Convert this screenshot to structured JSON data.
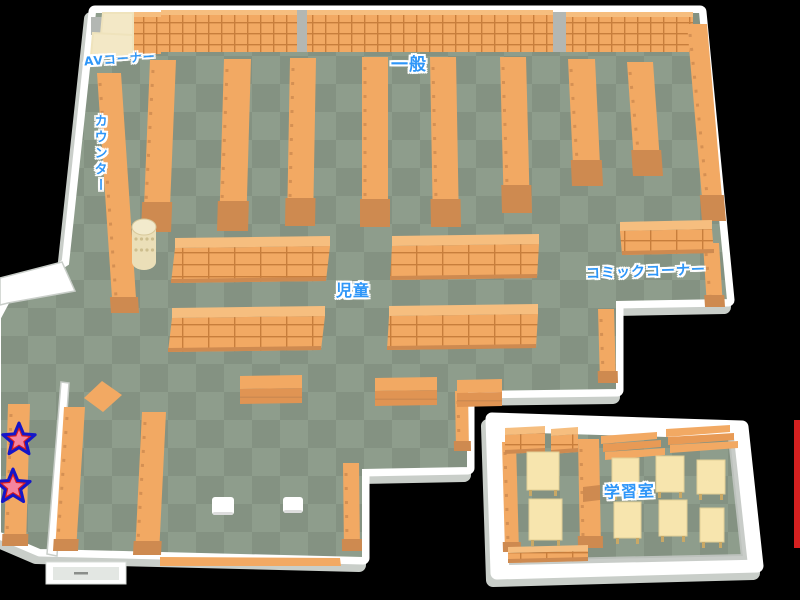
{
  "map": {
    "title_labels": "library floor map",
    "colors": {
      "bg": "#000000",
      "floorA": "#8E9D8C",
      "floorB": "#849282",
      "wall": "#FFFFFF",
      "wallShadow": "#C9CEC9",
      "wallInner": "#C2C6C2",
      "shelf": "#F2A963",
      "shelfLight": "#F6BE7F",
      "shelfDark": "#CE8A50",
      "shelfLine": "#C87E3C",
      "cream": "#F3E8C6",
      "cream2": "#EFE3BC",
      "desk": "#F7E5AE",
      "deskLeg": "#C9A865",
      "pillar": "#B3B7B3",
      "labelBlue": "#2E96F8",
      "starBlue": "#1616C8",
      "starRed": "#DC1C1C",
      "starPink": "#F5849E",
      "stool": "#FFFFFF",
      "red": "#D42020",
      "cylTop": "#F2EACC",
      "cylBody": "#EBDFB8",
      "cylDot": "#CDBE8E"
    },
    "rooms": [
      {
        "name": "main-hall-floor",
        "pts": [
          [
            95,
            12
          ],
          [
            700,
            12
          ],
          [
            728,
            300
          ],
          [
            617,
            302
          ],
          [
            617,
            390
          ],
          [
            468,
            392
          ],
          [
            468,
            468
          ],
          [
            363,
            470
          ],
          [
            363,
            558
          ],
          [
            40,
            550
          ],
          [
            0,
            533
          ],
          [
            0,
            318
          ],
          [
            8,
            303
          ],
          [
            68,
            264
          ]
        ]
      },
      {
        "name": "study-room-floor",
        "pts": [
          [
            504,
            431
          ],
          [
            731,
            438
          ],
          [
            744,
            557
          ],
          [
            509,
            562
          ]
        ],
        "outer": [
          [
            492,
            419
          ],
          [
            742,
            427
          ],
          [
            757,
            566
          ],
          [
            497,
            573
          ]
        ]
      }
    ],
    "wall_slivers": [
      {
        "name": "partition-wall",
        "pts": [
          [
            61,
            382
          ],
          [
            69,
            383
          ],
          [
            57,
            556
          ],
          [
            47,
            554
          ]
        ]
      },
      {
        "name": "west-jut-wall",
        "pts": [
          [
            0,
            278
          ],
          [
            62,
            262
          ],
          [
            75,
            291
          ],
          [
            8,
            303
          ],
          [
            0,
            305
          ]
        ]
      }
    ],
    "bands": [
      {
        "name": "wall-shelf-band",
        "x": 133,
        "y": 12,
        "w": 28,
        "h": 42
      },
      {
        "name": "wall-shelf-band",
        "x": 161,
        "y": 10,
        "w": 136,
        "h": 42
      },
      {
        "name": "wall-shelf-band",
        "x": 307,
        "y": 10,
        "w": 246,
        "h": 42
      },
      {
        "name": "wall-shelf-band",
        "x": 566,
        "y": 12,
        "w": 127,
        "h": 40
      }
    ],
    "pillars": [
      {
        "name": "support-pillar",
        "x": 297,
        "y": 10,
        "w": 10,
        "h": 42
      },
      {
        "name": "support-pillar",
        "x": 553,
        "y": 12,
        "w": 13,
        "h": 40
      },
      {
        "name": "support-pillar",
        "x": 91,
        "y": 17,
        "w": 12,
        "h": 18
      }
    ],
    "creams": [
      {
        "name": "av-booth",
        "pts": [
          [
            103,
            13
          ],
          [
            133,
            13
          ],
          [
            133,
            35
          ],
          [
            101,
            35
          ]
        ]
      },
      {
        "name": "av-booth",
        "pts": [
          [
            93,
            33
          ],
          [
            133,
            35
          ],
          [
            133,
            56
          ],
          [
            91,
            56
          ]
        ]
      }
    ],
    "vshelves": [
      {
        "name": "counter-desk",
        "x": 97,
        "y": 73,
        "w": 24,
        "h": 240,
        "lean": 16,
        "base": 16
      },
      {
        "name": "bookshelf",
        "x": 150,
        "y": 60,
        "w": 26,
        "h": 172,
        "lean": -7,
        "base": 30
      },
      {
        "name": "bookshelf",
        "x": 224,
        "y": 59,
        "w": 27,
        "h": 172,
        "lean": -5,
        "base": 30
      },
      {
        "name": "bookshelf",
        "x": 290,
        "y": 58,
        "w": 26,
        "h": 168,
        "lean": -3,
        "base": 28
      },
      {
        "name": "bookshelf",
        "x": 362,
        "y": 57,
        "w": 26,
        "h": 170,
        "lean": 0,
        "base": 28
      },
      {
        "name": "bookshelf",
        "x": 430,
        "y": 57,
        "w": 26,
        "h": 170,
        "lean": 3,
        "base": 28
      },
      {
        "name": "bookshelf",
        "x": 500,
        "y": 57,
        "w": 26,
        "h": 156,
        "lean": 4,
        "base": 28
      },
      {
        "name": "bookshelf",
        "x": 568,
        "y": 59,
        "w": 27,
        "h": 127,
        "lean": 6,
        "base": 26
      },
      {
        "name": "bookshelf",
        "x": 627,
        "y": 62,
        "w": 26,
        "h": 114,
        "lean": 8,
        "base": 26
      },
      {
        "name": "wall-bookshelf",
        "x": 687,
        "y": 24,
        "w": 20,
        "h": 197,
        "lean": 17,
        "base": 26
      },
      {
        "name": "comic-shelf",
        "x": 703,
        "y": 243,
        "w": 16,
        "h": 64,
        "lean": 4,
        "base": 12
      },
      {
        "name": "comic-shelf",
        "x": 598,
        "y": 309,
        "w": 16,
        "h": 74,
        "lean": 2,
        "base": 12
      },
      {
        "name": "wall-bookshelf",
        "x": 455,
        "y": 391,
        "w": 13,
        "h": 60,
        "lean": 1,
        "base": 10
      },
      {
        "name": "wall-bookshelf",
        "x": 343,
        "y": 463,
        "w": 16,
        "h": 88,
        "lean": 1,
        "base": 12
      },
      {
        "name": "star-bookshelf",
        "x": 8,
        "y": 404,
        "w": 22,
        "h": 142,
        "lean": -4,
        "base": 12
      },
      {
        "name": "bookshelf",
        "x": 64,
        "y": 407,
        "w": 21,
        "h": 144,
        "lean": -9,
        "base": 12
      },
      {
        "name": "bookshelf",
        "x": 142,
        "y": 412,
        "w": 24,
        "h": 143,
        "lean": -7,
        "base": 14
      },
      {
        "name": "study-wall-shelf",
        "x": 502,
        "y": 442,
        "w": 14,
        "h": 110,
        "lean": 3,
        "base": 10
      },
      {
        "name": "study-divider-shelf",
        "x": 578,
        "y": 439,
        "w": 21,
        "h": 109,
        "lean": 2,
        "base": 12
      }
    ],
    "hshelves": [
      {
        "name": "kids-bookshelf",
        "x": 175,
        "y": 238,
        "w": 155,
        "topH": 10,
        "frontH": 35,
        "lean": -4
      },
      {
        "name": "kids-bookshelf",
        "x": 392,
        "y": 236,
        "w": 147,
        "topH": 10,
        "frontH": 34,
        "lean": -2
      },
      {
        "name": "kids-bookshelf",
        "x": 172,
        "y": 308,
        "w": 153,
        "topH": 10,
        "frontH": 34,
        "lean": -4
      },
      {
        "name": "kids-bookshelf",
        "x": 389,
        "y": 306,
        "w": 149,
        "topH": 10,
        "frontH": 34,
        "lean": -2
      },
      {
        "name": "comic-bookshelf",
        "x": 620,
        "y": 222,
        "w": 92,
        "topH": 9,
        "frontH": 24,
        "lean": 2
      },
      {
        "name": "study-shelf",
        "x": 508,
        "y": 547,
        "w": 80,
        "topH": 6,
        "frontH": 10,
        "lean": 0
      },
      {
        "name": "study-shelf",
        "x": 505,
        "y": 428,
        "w": 40,
        "topH": 7,
        "frontH": 19,
        "lean": 0
      },
      {
        "name": "study-shelf",
        "x": 551,
        "y": 429,
        "w": 27,
        "topH": 7,
        "frontH": 18,
        "lean": 0
      }
    ],
    "tables": [
      {
        "name": "reading-table",
        "x": 240,
        "y": 376,
        "w": 62,
        "topH": 13,
        "frontH": 15
      },
      {
        "name": "reading-table",
        "x": 375,
        "y": 378,
        "w": 62,
        "topH": 13,
        "frontH": 15
      },
      {
        "name": "reading-table",
        "x": 457,
        "y": 380,
        "w": 45,
        "topH": 13,
        "frontH": 14
      }
    ],
    "racks": [
      {
        "name": "magazine-rack",
        "x": 601,
        "y": 436,
        "w": 56
      },
      {
        "name": "magazine-rack",
        "x": 666,
        "y": 429,
        "w": 64
      }
    ],
    "desks": [
      {
        "name": "study-desk",
        "x": 527,
        "y": 452,
        "w": 32,
        "h": 38
      },
      {
        "name": "study-desk",
        "x": 529,
        "y": 499,
        "w": 33,
        "h": 41
      },
      {
        "name": "study-desk",
        "x": 612,
        "y": 458,
        "w": 27,
        "h": 36
      },
      {
        "name": "study-desk",
        "x": 656,
        "y": 456,
        "w": 28,
        "h": 36
      },
      {
        "name": "study-desk",
        "x": 697,
        "y": 460,
        "w": 28,
        "h": 34
      },
      {
        "name": "study-desk",
        "x": 614,
        "y": 502,
        "w": 27,
        "h": 36
      },
      {
        "name": "study-desk",
        "x": 659,
        "y": 500,
        "w": 28,
        "h": 36
      },
      {
        "name": "study-desk",
        "x": 700,
        "y": 508,
        "w": 24,
        "h": 34
      }
    ],
    "stools": [
      {
        "name": "stool",
        "x": 212,
        "y": 497,
        "w": 22,
        "h": 18
      },
      {
        "name": "stool",
        "x": 283,
        "y": 497,
        "w": 20,
        "h": 16
      }
    ],
    "quads": [
      {
        "name": "display-table",
        "pts": [
          [
            102,
            381
          ],
          [
            122,
            395
          ],
          [
            103,
            412
          ],
          [
            84,
            398
          ]
        ],
        "fill": "shelf"
      },
      {
        "name": "bottom-wall-shelf",
        "pts": [
          [
            160,
            557
          ],
          [
            340,
            558
          ],
          [
            341,
            566
          ],
          [
            160,
            566
          ]
        ],
        "fill": "shelf"
      },
      {
        "name": "divider-notch",
        "pts": [
          [
            583,
            487
          ],
          [
            600,
            485
          ],
          [
            600,
            500
          ],
          [
            583,
            502
          ]
        ],
        "fill": "shelfDark"
      }
    ],
    "cylinder": {
      "name": "rotating-book-rack",
      "cx": 144,
      "cy": 227,
      "rx": 12,
      "ry": 8,
      "h": 35
    },
    "window": {
      "name": "entrance-window",
      "x": 46,
      "y": 562,
      "w": 80,
      "h": 22
    },
    "stars": [
      {
        "name": "star-marker",
        "cx": 19,
        "cy": 440,
        "r": 12
      },
      {
        "name": "star-marker",
        "cx": 13,
        "cy": 487,
        "r": 13
      }
    ],
    "red_strip": {
      "name": "red-edge-marker",
      "x": 794,
      "y": 420,
      "w": 6,
      "h": 128
    },
    "labels": [
      {
        "id": "av-corner",
        "text": "AVコーナー",
        "x": 84,
        "y": 53,
        "size": 12,
        "rot": -4
      },
      {
        "id": "general",
        "text": "一般",
        "x": 391,
        "y": 57,
        "size": 17,
        "rot": 0
      },
      {
        "id": "counter",
        "text": "カウンター",
        "x": 92,
        "y": 114,
        "size": 13,
        "rot": 0,
        "vertical": true
      },
      {
        "id": "children",
        "text": "児童",
        "x": 336,
        "y": 283,
        "size": 16,
        "rot": 0
      },
      {
        "id": "comic-corner",
        "text": "コミックコーナー",
        "x": 586,
        "y": 265,
        "size": 14,
        "rot": -2
      },
      {
        "id": "study-room",
        "text": "学習室",
        "x": 604,
        "y": 484,
        "size": 16,
        "rot": -2
      }
    ]
  }
}
